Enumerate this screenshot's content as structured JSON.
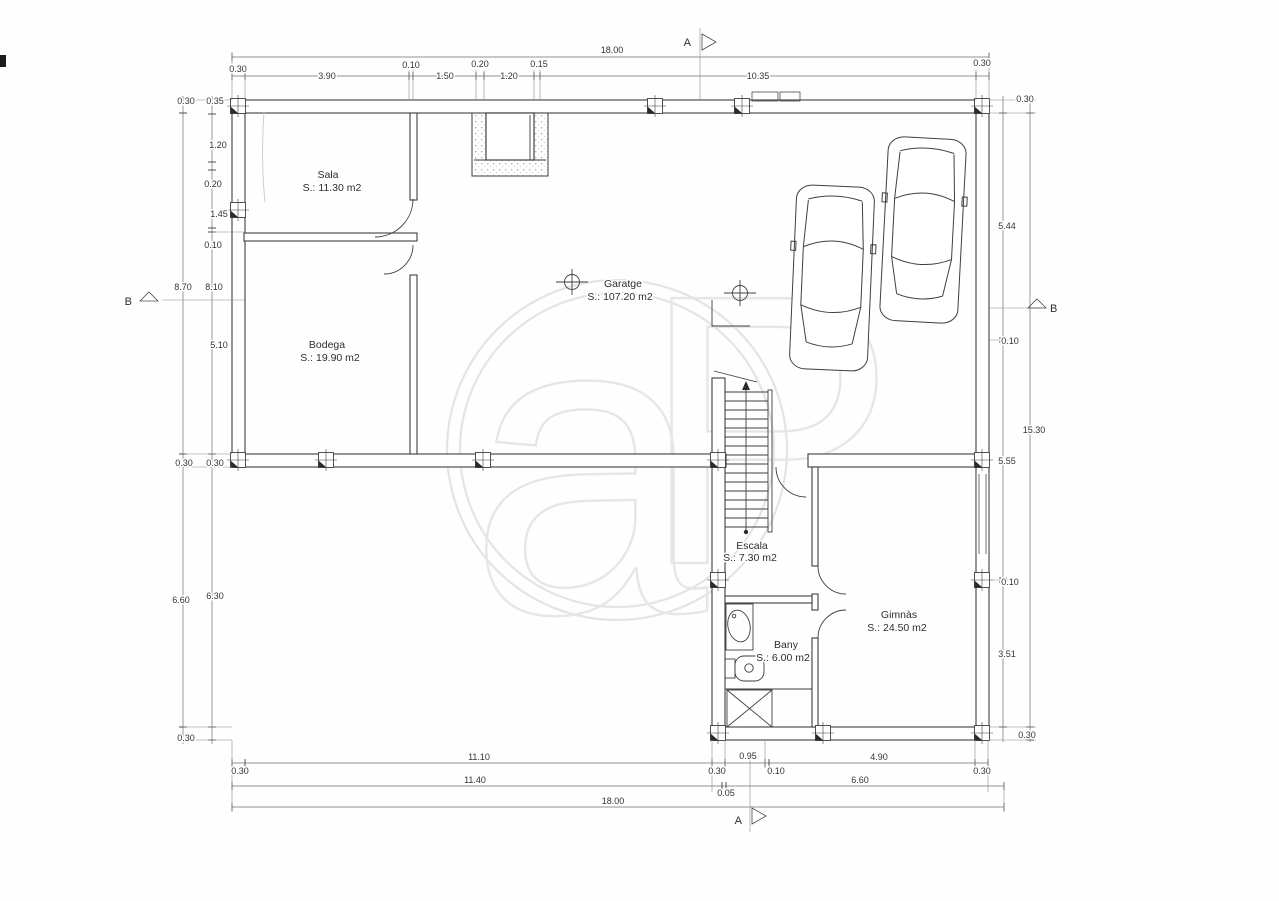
{
  "rooms": [
    {
      "name": "Sala",
      "area": "S.: 11.30 m2"
    },
    {
      "name": "Bodega",
      "area": "S.: 19.90 m2"
    },
    {
      "name": "Garatge",
      "area": "S.: 107.20 m2"
    },
    {
      "name": "Escala",
      "area": "S.: 7.30 m2"
    },
    {
      "name": "Bany",
      "area": "S.: 6.00 m2"
    },
    {
      "name": "Gimnàs",
      "area": "S.: 24.50 m2"
    }
  ],
  "dims": {
    "top_total": "18.00",
    "top": [
      "0.30",
      "3.90",
      "0.10",
      "1.50",
      "0.20",
      "1.20",
      "0.15",
      "10.35",
      "0.30"
    ],
    "left_outer": [
      "0.30",
      "8.70",
      "0.30",
      "6.60",
      "0.30"
    ],
    "left_inner": [
      "0.35",
      "1.20",
      "0.20",
      "1.45",
      "0.10",
      "8.10",
      "5.10",
      "0.30",
      "6.30"
    ],
    "right_inner": [
      "5.44",
      "0.10",
      "5.55",
      "0.10",
      "3.51"
    ],
    "right_outer": [
      "0.30",
      "15.30",
      "0.30"
    ],
    "bottom_row1": [
      "0.30",
      "11.10",
      "0.30",
      "0.95",
      "0.10",
      "4.90",
      "0.30"
    ],
    "bottom_row2": [
      "11.40",
      "0.05",
      "6.60"
    ],
    "bottom_total": "18.00"
  },
  "markers": {
    "a": "A",
    "b": "B"
  },
  "watermark": {
    "letters": [
      "a",
      "P"
    ]
  },
  "colors": {
    "line": "#3f3f3f",
    "dimline": "#6f6f6f",
    "watermark": "#e5e5e5",
    "background": "#fefefe"
  }
}
